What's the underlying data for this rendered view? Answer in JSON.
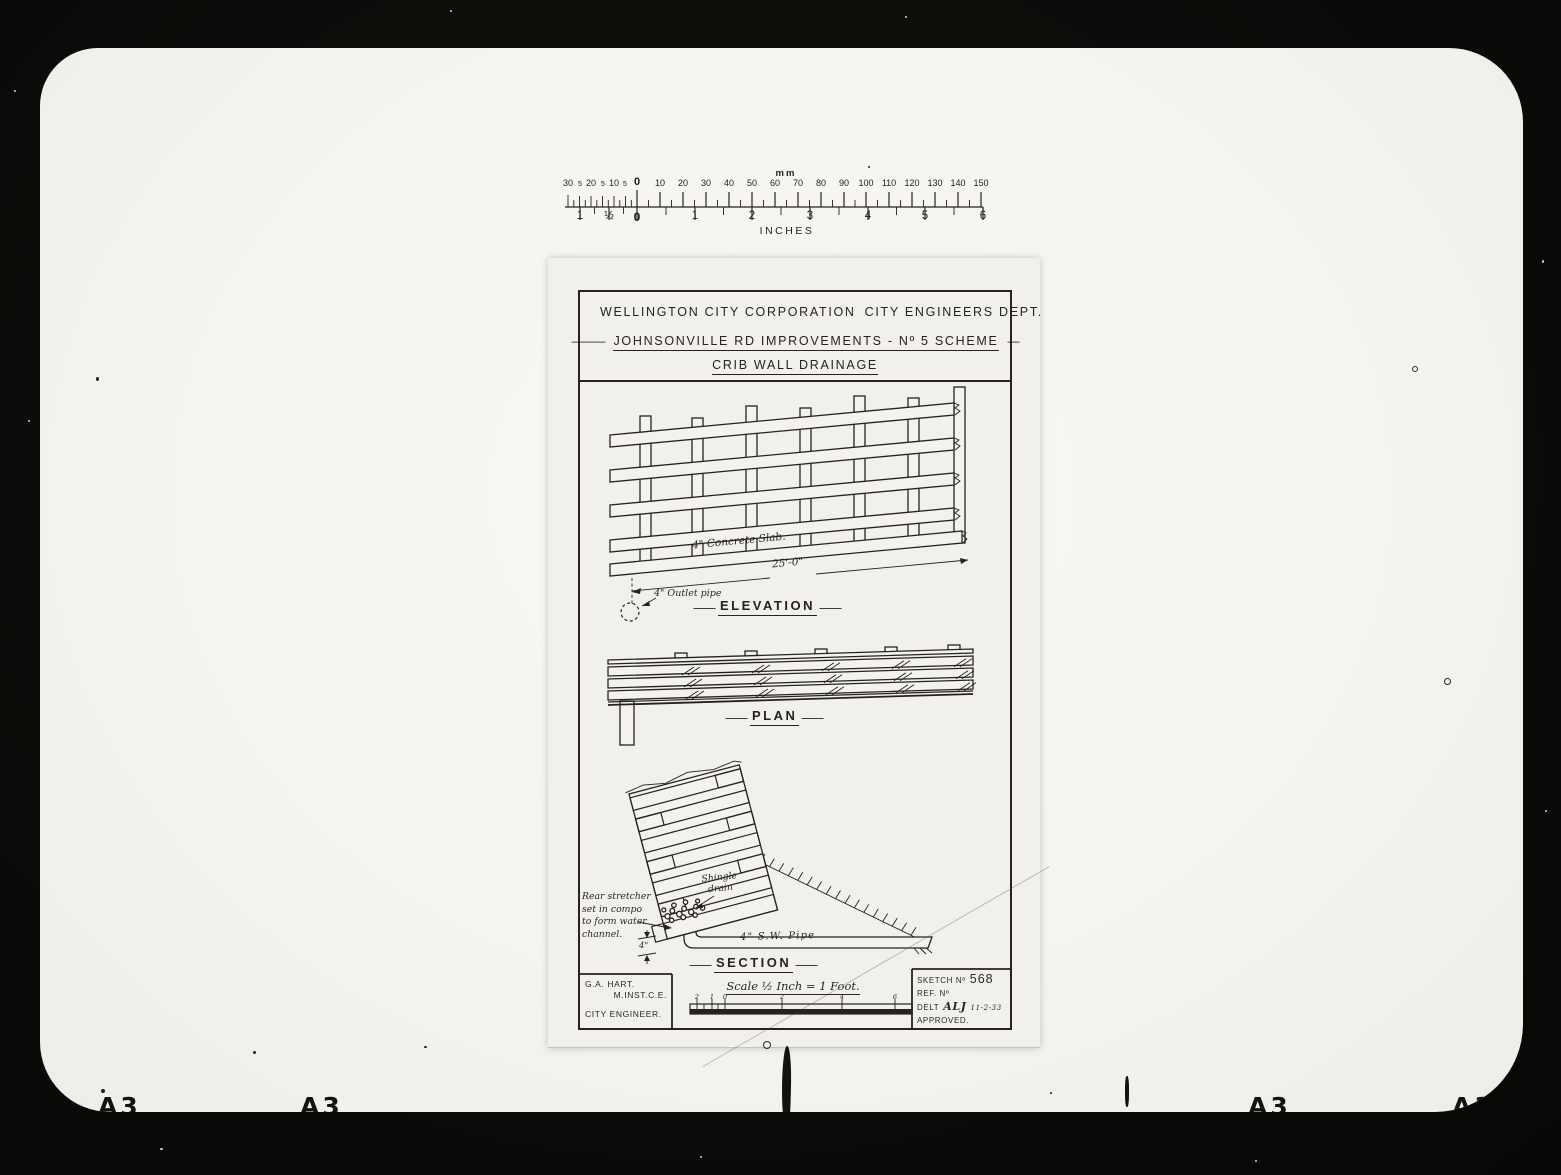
{
  "colors": {
    "film": "#0c0b09",
    "paper": "#f5f4f0",
    "sheet": "#f1f0ea",
    "ink": "#26231e"
  },
  "misc": {
    "dash": "—",
    "long_dash": "———"
  },
  "ruler": {
    "unit_top": "mm",
    "unit_bottom": "INCHES",
    "mm_labels": [
      {
        "t": "30",
        "x": 8
      },
      {
        "t": "5",
        "x": 20,
        "small": true
      },
      {
        "t": "20",
        "x": 31
      },
      {
        "t": "5",
        "x": 43,
        "small": true
      },
      {
        "t": "10",
        "x": 54
      },
      {
        "t": "5",
        "x": 65,
        "small": true
      },
      {
        "t": "0",
        "x": 77,
        "bold": true
      },
      {
        "t": "10",
        "x": 100
      },
      {
        "t": "20",
        "x": 123
      },
      {
        "t": "30",
        "x": 146
      },
      {
        "t": "40",
        "x": 169
      },
      {
        "t": "50",
        "x": 192
      },
      {
        "t": "60",
        "x": 215
      },
      {
        "t": "70",
        "x": 238
      },
      {
        "t": "80",
        "x": 261
      },
      {
        "t": "90",
        "x": 284
      },
      {
        "t": "100",
        "x": 306
      },
      {
        "t": "110",
        "x": 329
      },
      {
        "t": "120",
        "x": 352
      },
      {
        "t": "130",
        "x": 375
      },
      {
        "t": "140",
        "x": 398
      },
      {
        "t": "150",
        "x": 421
      }
    ],
    "inch_labels": [
      {
        "t": "1",
        "x": 20
      },
      {
        "t": "½",
        "x": 49
      },
      {
        "t": "0",
        "x": 77,
        "bold": true
      },
      {
        "t": "1",
        "x": 135
      },
      {
        "t": "2",
        "x": 192
      },
      {
        "t": "3",
        "x": 250
      },
      {
        "t": "4",
        "x": 308
      },
      {
        "t": "5",
        "x": 365
      },
      {
        "t": "6",
        "x": 423
      }
    ]
  },
  "sheet": {
    "header": {
      "org": "WELLINGTON CITY CORPORATION",
      "dept": "CITY ENGINEERS DEPT.",
      "project": "JOHNSONVILLE RD IMPROVEMENTS - Nº 5 SCHEME",
      "subtitle": "CRIB WALL DRAINAGE"
    },
    "figures": {
      "elevation": {
        "label": "ELEVATION",
        "slab_note": "4\" Concrete Slab.",
        "span_dim": "25'-0\"",
        "outlet_note": "4\" Outlet pipe"
      },
      "plan": {
        "label": "PLAN"
      },
      "section": {
        "label": "SECTION",
        "rear_note_lines": [
          "Rear stretcher",
          "set in compo",
          "to form water",
          "channel."
        ],
        "channel_dim": "4\"",
        "shingle_note_lines": [
          "Shingle",
          "drain"
        ],
        "pipe_note": "4\" S.W. Pipe"
      }
    },
    "titleblock": {
      "engineer": {
        "name": "G.A. HART.",
        "qualification": "M.INST.C.E.",
        "title": "CITY ENGINEER."
      },
      "scale_note": "Scale ½ Inch = 1 Foot.",
      "scalebar_labels": [
        {
          "t": "2",
          "x": 117
        },
        {
          "t": "1",
          "x": 132
        },
        {
          "t": "0",
          "x": 145
        },
        {
          "t": "2",
          "x": 202
        },
        {
          "t": "4",
          "x": 262
        },
        {
          "t": "6",
          "x": 315
        }
      ],
      "sketch_label": "SKETCH Nº",
      "sketch_no": "568",
      "ref_label": "REF. Nº",
      "delt_label": "DELT",
      "delt_initials": "ALJ",
      "delt_date": "11-2-33",
      "approved_label": "APPROVED."
    }
  },
  "photo": {
    "edge_marks": [
      {
        "t": "A3",
        "x": 58
      },
      {
        "t": "A3",
        "x": 260
      },
      {
        "t": "A3",
        "x": 1208
      },
      {
        "t": "A3",
        "x": 1412
      }
    ]
  }
}
